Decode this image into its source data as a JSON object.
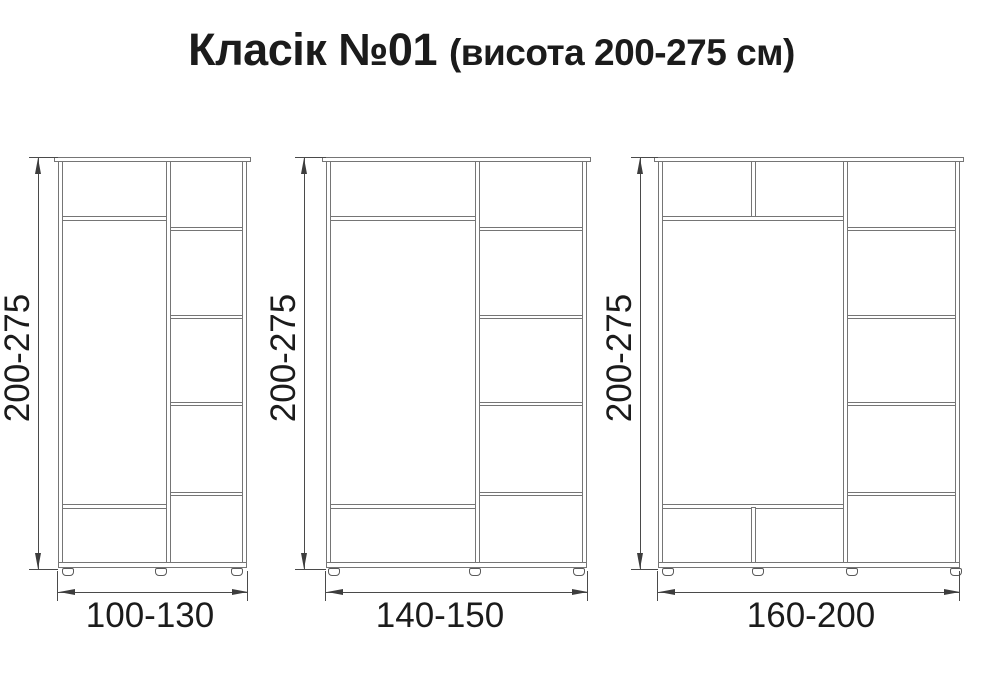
{
  "title": {
    "main": "Класік №01",
    "sub": "(висота 200-275 см)"
  },
  "figures": [
    {
      "name": "wardrobe-100-130",
      "height_label": "200-275",
      "width_label": "100-130",
      "left_section": "top shelf compartment, tall hanging space, bottom compartment",
      "right_section": "column of 5 shelf compartments",
      "feet_count": 3
    },
    {
      "name": "wardrobe-140-150",
      "height_label": "200-275",
      "width_label": "140-150",
      "left_section": "top shelf compartment, tall hanging space, bottom compartment",
      "right_section": "column of 5 shelf compartments",
      "feet_count": 3
    },
    {
      "name": "wardrobe-160-200",
      "height_label": "200-275",
      "width_label": "160-200",
      "left_section": "top compartment split in two, tall hanging space, bottom compartment split in two",
      "right_section": "column of 5 shelf compartments",
      "feet_count": 4
    }
  ],
  "colors": {
    "background": "#ffffff",
    "board_line": "#757575",
    "dimension_line": "#4a4a4a",
    "text": "#1b1b1b"
  }
}
